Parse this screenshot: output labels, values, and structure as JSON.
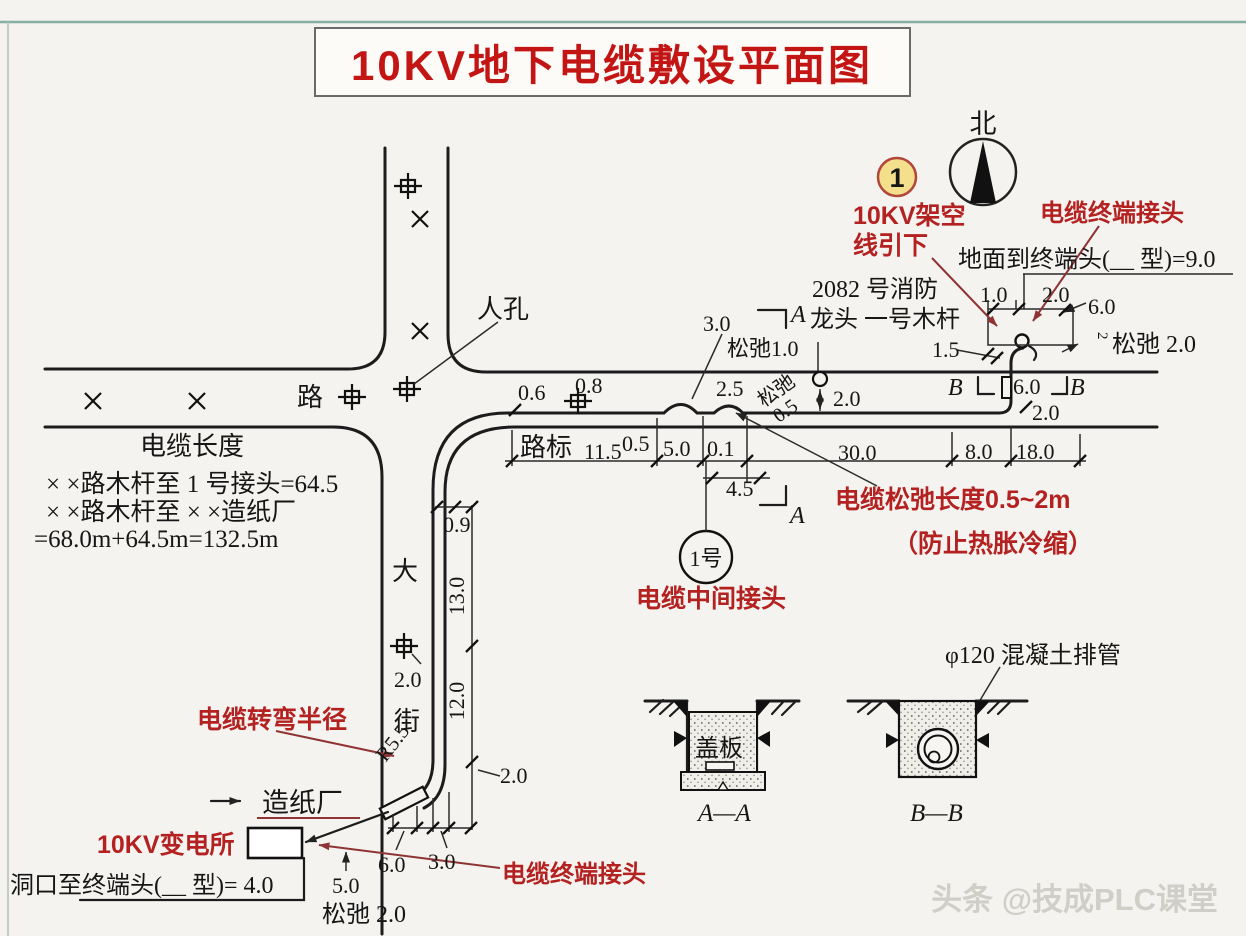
{
  "title": "10KV地下电缆敷设平面图",
  "watermark": "头条 @技成PLC课堂",
  "compass": {
    "north": "北"
  },
  "badge": {
    "num": "1"
  },
  "red": {
    "overhead1": "10KV架空",
    "overhead2": "线引下",
    "terminal_top": "电缆终端接头",
    "slack_len": "电缆松弛长度0.5~2m",
    "slack_reason": "（防止热胀冷缩）",
    "mid_joint": "电缆中间接头",
    "bend_radius": "电缆转弯半径",
    "substation": "10KV变电所",
    "terminal_bottom": "电缆终端接头"
  },
  "labels": {
    "ground_to_term": "地面到终端头(__ 型)=9.0",
    "hydrant_no": "2082 号消防",
    "hydrant_pole": "龙头  一号木杆",
    "manhole": "人孔",
    "road": "路",
    "road_sign": "路标",
    "street1": "大",
    "street2": "街",
    "paper_mill": "造纸厂",
    "opening_to_term": "洞口至终端头(__ 型)= 4.0",
    "joint_no": "1号",
    "cover": "盖板",
    "pipe": "φ120 混凝土排管",
    "sec_aa": "A—A",
    "sec_bb": "B—B",
    "a": "A",
    "b": "B"
  },
  "cable_note": {
    "heading": "电缆长度",
    "l1": "× ×路木杆至 1 号接头=64.5",
    "l2": "× ×路木杆至 × ×造纸厂",
    "l3": "=68.0m+64.5m=132.5m"
  },
  "dims": {
    "p10": "1.0",
    "p20": "2.0",
    "p60": "6.0",
    "p15": "1.5",
    "slack20r": "松弛 2.0",
    "rot2": "2",
    "b60": "6.0",
    "b20": "2.0",
    "slack10": "松弛1.0",
    "d30": "3.0",
    "d25": "2.5",
    "slackw": "松弛",
    "slackw05": "0.5",
    "hyd20": "2.0",
    "d06": "0.6",
    "d08": "0.8",
    "c115": "11.5",
    "c05": "0.5",
    "c50": "5.0",
    "c01": "0.1",
    "c45": "4.5",
    "c300": "30.0",
    "c80": "8.0",
    "c180": "18.0",
    "v09": "0.9",
    "v130": "13.0",
    "v20": "2.0",
    "v120": "12.0",
    "r55": "R5.5",
    "vb20": "2.0",
    "t50": "5.0",
    "t60": "6.0",
    "t30": "3.0",
    "slack20b": "松弛 2.0"
  },
  "colors": {
    "annotation_red": "#b32121",
    "title_red": "#c41515",
    "leader_red": "#8f3434",
    "badge_yellow": "#f4df8d"
  }
}
